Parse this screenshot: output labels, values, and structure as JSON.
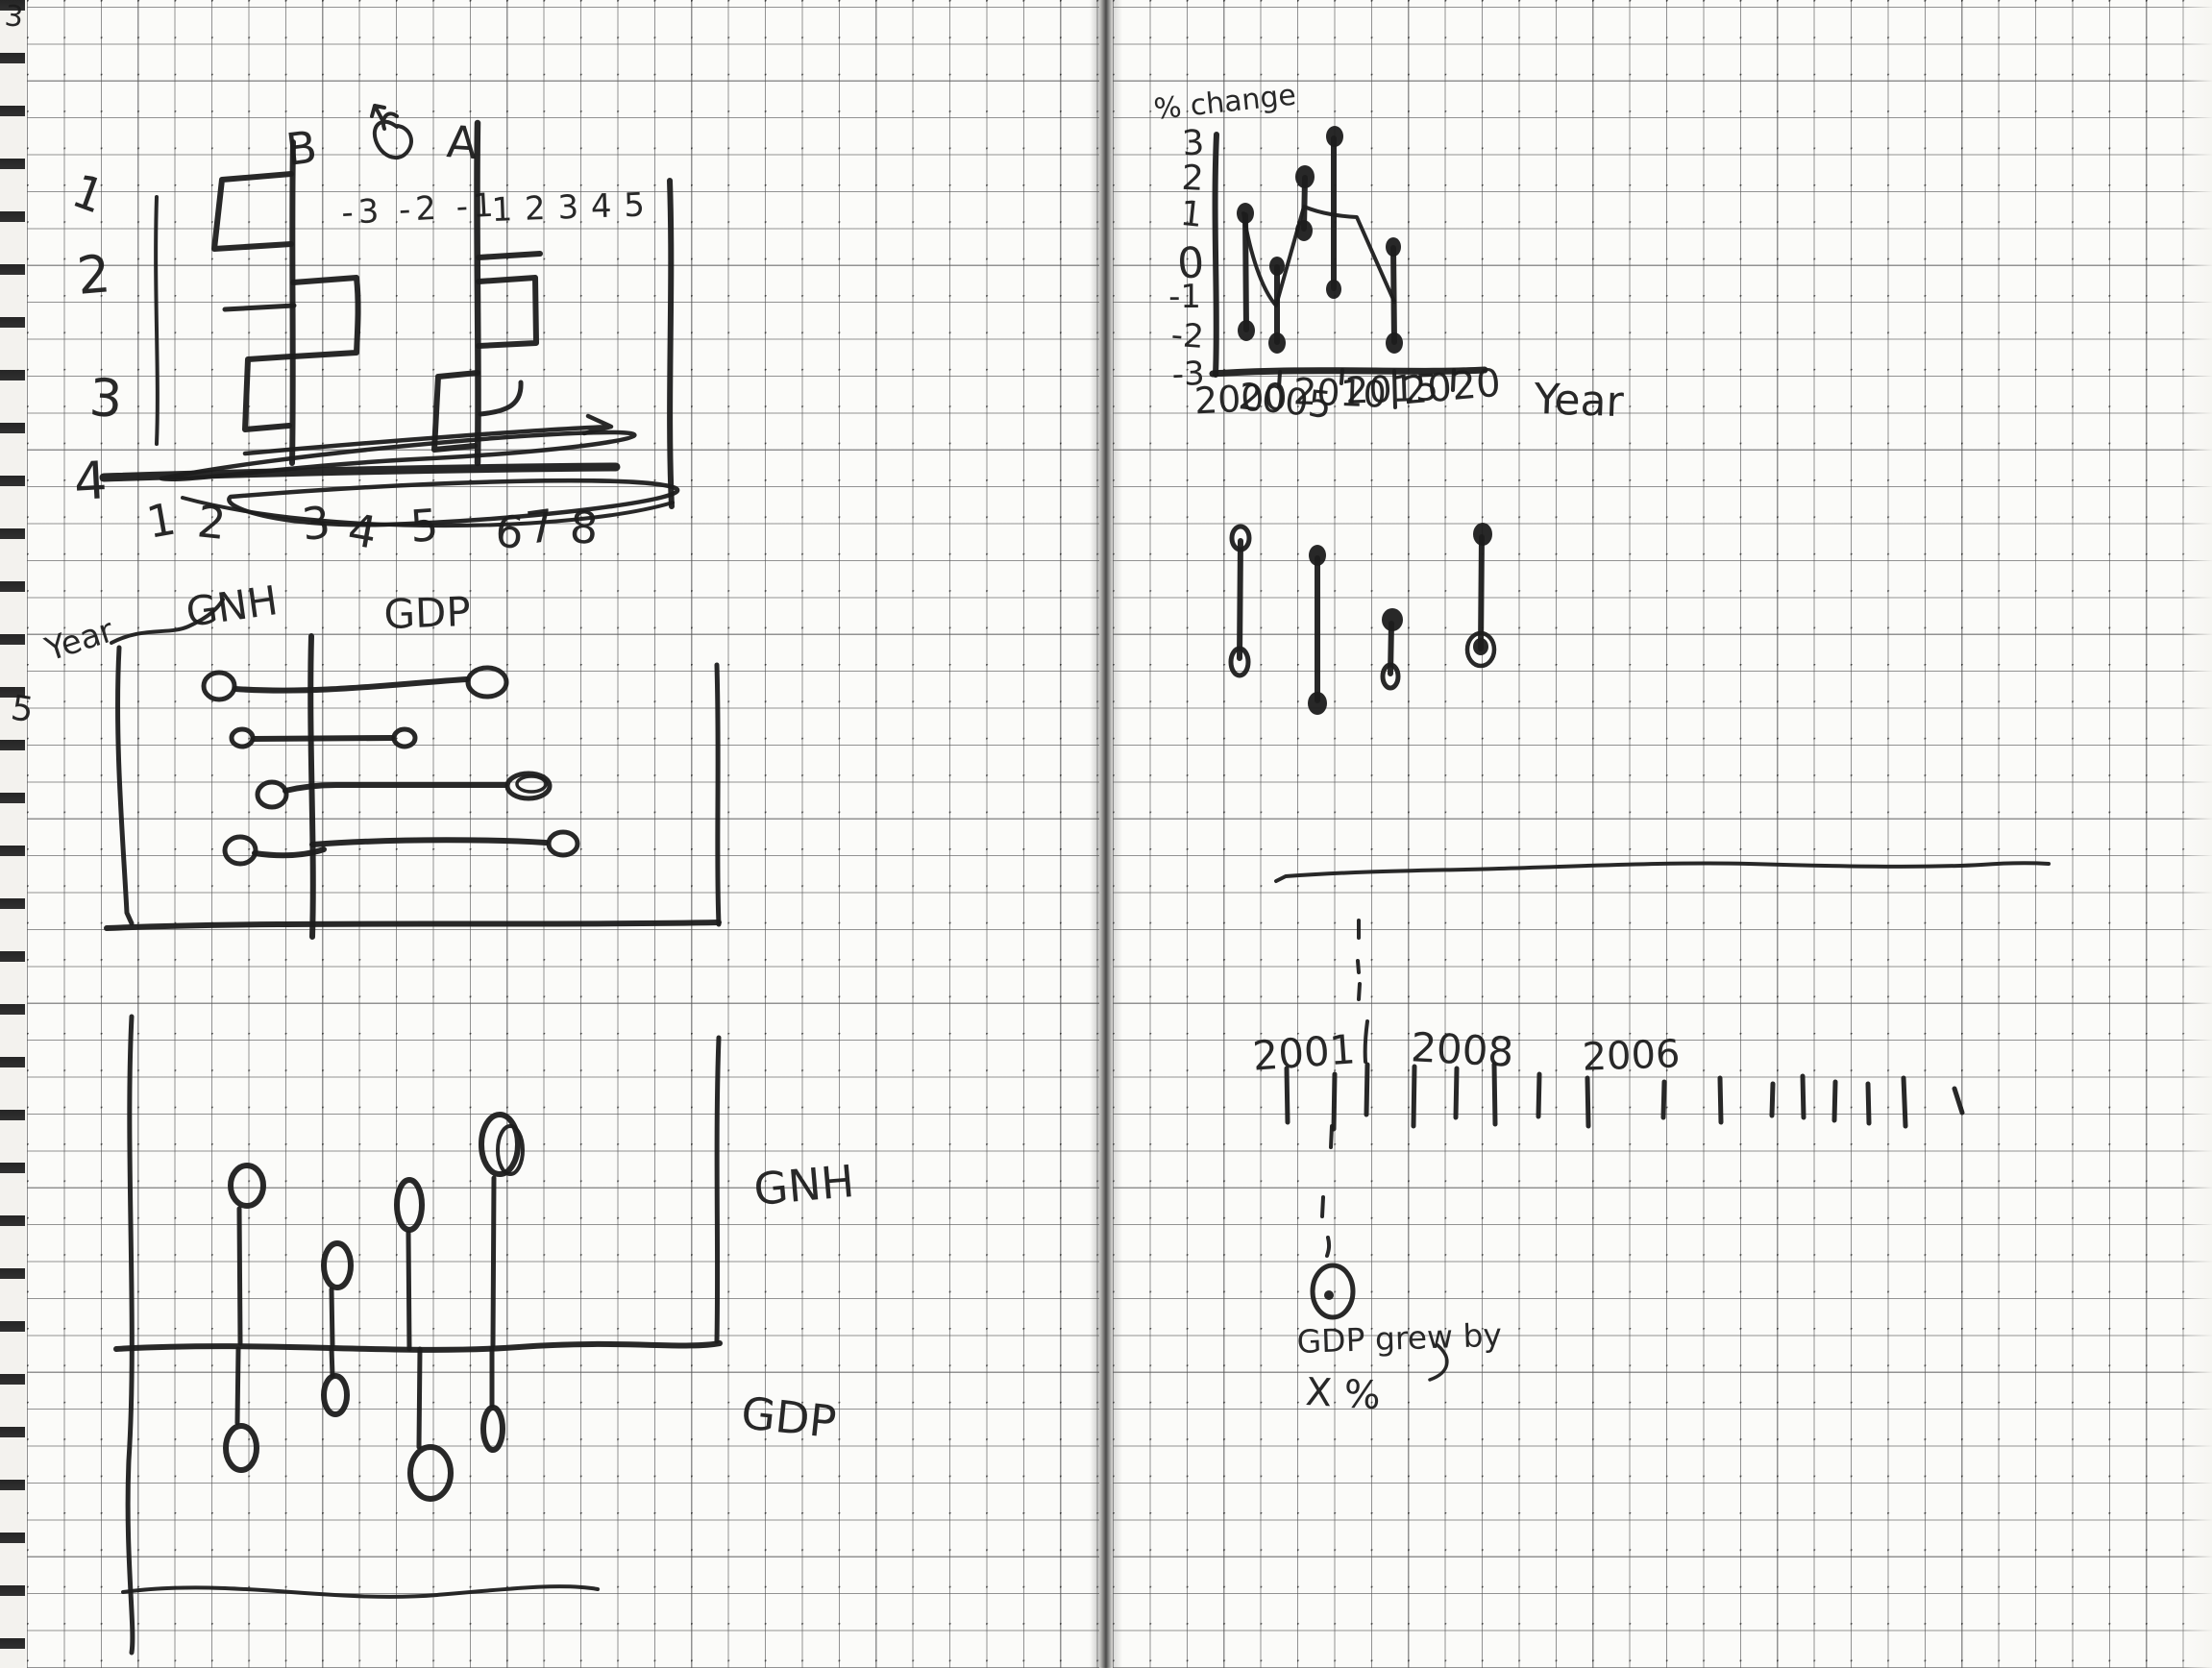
{
  "left_page": {
    "corner_mark": "3",
    "margin_row_numbers": [
      "1",
      "2",
      "3",
      "4"
    ],
    "margin_mark": "5",
    "pyramid_sketch": {
      "label_b": "B",
      "label_a": "A",
      "neg_ticks": "-3 -2 -1",
      "pos_ticks": "1 2 3 4 5",
      "bottom_numbers": [
        "1",
        "2",
        "3",
        "4",
        "5",
        "6",
        "7",
        "8"
      ]
    },
    "dumbbell_chart": {
      "axis_label": "Year",
      "left_label": "GNH",
      "right_label": "GDP"
    },
    "lollipop_chart": {
      "upper_label": "GNH",
      "lower_label": "GDP"
    }
  },
  "right_page": {
    "range_chart": {
      "y_axis_label": "% change",
      "x_axis_label": "Year",
      "y_ticks": [
        "3",
        "2",
        "1",
        "0",
        "-1",
        "-2",
        "-3"
      ],
      "x_ticks": [
        "2000",
        "2005",
        "2010",
        "2015",
        "2020"
      ]
    },
    "timeline": {
      "year_labels": [
        "2001",
        "2008",
        "2006"
      ],
      "note_line1": "GDP grew by",
      "note_line2": "X %"
    }
  },
  "chart_data": [
    {
      "type": "line",
      "subtype": "high-low range bars with trend line (hand-drawn)",
      "title": "% change by Year",
      "xlabel": "Year",
      "ylabel": "% change",
      "x": [
        2000,
        2004,
        2007,
        2010,
        2015
      ],
      "series": [
        {
          "name": "upper value",
          "values": [
            1,
            -0.5,
            2,
            3,
            0
          ]
        },
        {
          "name": "lower value",
          "values": [
            -2,
            -2.2,
            0.5,
            -1,
            -2.3
          ]
        }
      ],
      "trend_line_points": [
        [
          2000,
          1
        ],
        [
          2005,
          -1.1
        ],
        [
          2007,
          1.6
        ],
        [
          2010,
          1.3
        ],
        [
          2015,
          -1
        ]
      ],
      "ylim": [
        -3,
        3
      ],
      "yticks": [
        3,
        2,
        1,
        0,
        -1,
        -2,
        -3
      ],
      "xticks": [
        2000,
        2005,
        2010,
        2015,
        2020
      ],
      "grid": true
    },
    {
      "type": "bar",
      "subtype": "horizontal dumbbells from a center axis (sketch, no scale)",
      "title": "GNH vs GDP by Year",
      "rows": [
        {
          "gnh_left_extent": 2.5,
          "gdp_right_extent": 4.8
        },
        {
          "gnh_left_extent": 1.9,
          "gdp_right_extent": 2.5
        },
        {
          "gnh_left_extent": 1.0,
          "gdp_right_extent": 5.9
        },
        {
          "gnh_left_extent": 1.9,
          "gdp_right_extent": 6.9
        }
      ],
      "units": "grid squares (estimated)"
    },
    {
      "type": "bar",
      "subtype": "lollipops above and below a horizontal axis (sketch, no scale)",
      "title": "GNH above axis / GDP below axis",
      "above_axis_heights": [
        4.3,
        2.2,
        3.8,
        5.4
      ],
      "below_axis_depths": [
        2.7,
        1.3,
        3.4,
        2.2
      ],
      "units": "grid squares (estimated)"
    },
    {
      "type": "bar",
      "subtype": "four floating high-low segments with end dots (sketch, unlabeled)",
      "title": "floating ranges",
      "segment_spans_grid_squares": [
        [
          0,
          -3.3
        ],
        [
          -0.5,
          -4.5
        ],
        [
          -2.3,
          -3.7
        ],
        [
          0.1,
          -3.0
        ]
      ]
    },
    {
      "type": "bar",
      "subtype": "back-to-back step bars around two vertical axes (draft)",
      "title": "draft sketch with axes B and A",
      "notes": "A axis numbered -3 -2 -1 and 1 2 3 4 5; margin rows 1-4; bottom axis scribbled with arrow over numbers 1-8"
    },
    {
      "type": "line",
      "subtype": "timeline with tick marks and dashed callout",
      "title": "timeline",
      "labeled_ticks": [
        "2001",
        "2008",
        "2006"
      ],
      "tick_count": 16,
      "annotation": "GDP grew by X %"
    }
  ]
}
